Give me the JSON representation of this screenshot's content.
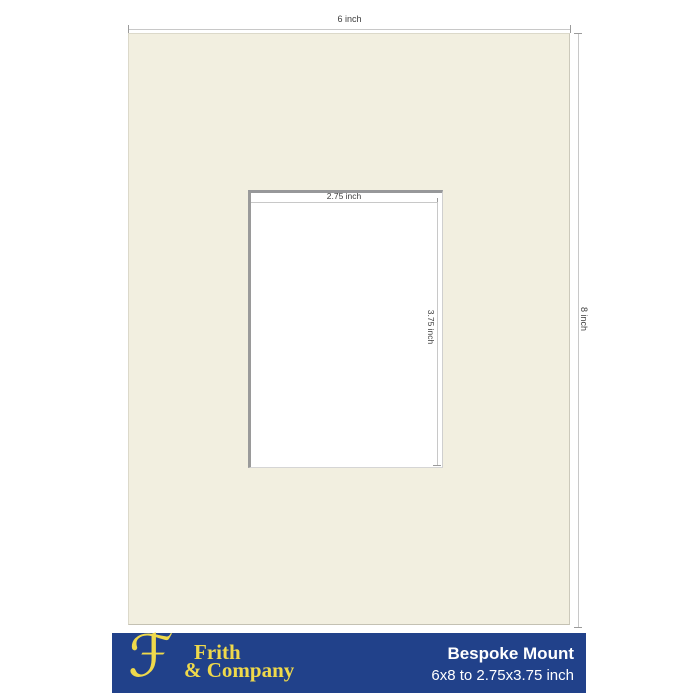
{
  "product": {
    "title": "Bespoke Mount",
    "size_description": "6x8 to 2.75x3.75 inch"
  },
  "brand": {
    "script_initial": "ℱ",
    "name_line1": "Frith",
    "name_line2": "& Company"
  },
  "dimensions": {
    "outer_width": "6 inch",
    "outer_height": "8 inch",
    "aperture_width": "2.75 inch",
    "aperture_height": "3.75 inch"
  },
  "colors": {
    "mount_board": "#F2EFE0",
    "aperture_window": "#FFFFFF",
    "footer_bar": "#21418A",
    "brand_yellow": "#EFD94B",
    "dimension_line": "#C8C8C8",
    "dimension_tick": "#9B9B9B",
    "dimension_text": "#3C3C3C",
    "footer_text": "#FFFFFF"
  }
}
